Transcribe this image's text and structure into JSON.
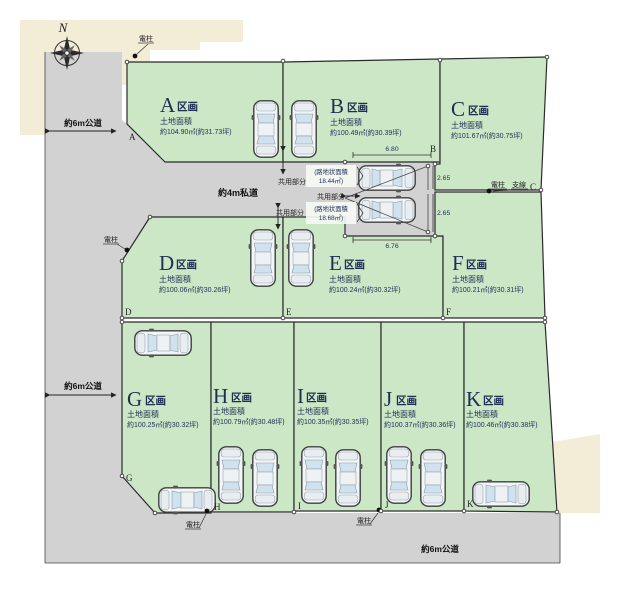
{
  "labels": {
    "kukaku_suffix": "区画",
    "area_caption": "土地面積",
    "common_area": "共用部分",
    "utility_pole": "電柱",
    "guy_wire": "支線",
    "north": "N"
  },
  "roads": {
    "left_top": "約6m公道",
    "left_mid": "約6m公道",
    "private": "約4m私道",
    "bottom": "約6m公道"
  },
  "plots": [
    {
      "letter": "A",
      "area": "約104.90㎡(約31.73坪)"
    },
    {
      "letter": "B",
      "area": "約100.49㎡(約30.39坪)"
    },
    {
      "letter": "C",
      "area": "約101.67㎡(約30.75坪)"
    },
    {
      "letter": "D",
      "area": "約100.06㎡(約30.26坪)"
    },
    {
      "letter": "E",
      "area": "約100.24㎡(約30.32坪)"
    },
    {
      "letter": "F",
      "area": "約100.21㎡(約30.31坪)"
    },
    {
      "letter": "G",
      "area": "約100.25㎡(約30.32坪)"
    },
    {
      "letter": "H",
      "area": "約100.79㎡(約30.48坪)"
    },
    {
      "letter": "I",
      "area": "約100.35㎡(約30.35坪)"
    },
    {
      "letter": "J",
      "area": "約100.37㎡(約30.36坪)"
    },
    {
      "letter": "K",
      "area": "約100.46㎡(約30.38坪)"
    }
  ],
  "flag_corridors": [
    {
      "caption": "(路地状面積",
      "value": "18.44㎡)"
    },
    {
      "caption": "(路地状面積",
      "value": "18.68㎡)"
    }
  ],
  "dimensions": {
    "top_width": "6.80",
    "bottom_width": "6.76",
    "upper_depth": "2.65",
    "lower_depth": "2.65"
  },
  "colors": {
    "plot_green": "#cbe7c6",
    "road_gray": "#d2d2d2",
    "beige": "#f3ecd6",
    "text_navy": "#1e2f55"
  }
}
